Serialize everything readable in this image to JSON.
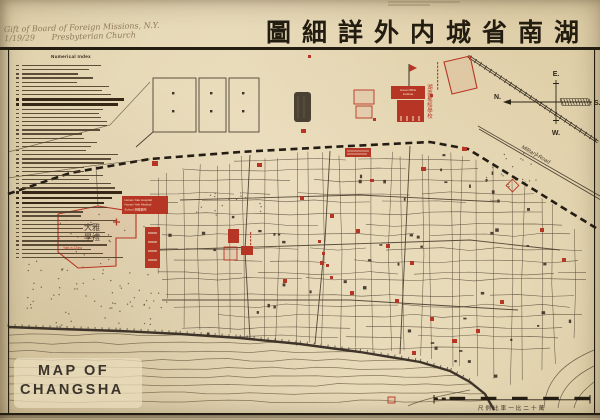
{
  "window": {
    "width": 600,
    "height": 420
  },
  "colors": {
    "paper": "#e9dcb9",
    "ink": "#241d12",
    "map_line": "#564737",
    "dark": "#3a3126",
    "red": "#b73524",
    "water": "#6f5f46"
  },
  "annotations": {
    "handwriting_line1": "Gift of Board of Foreign Missions, N.Y.",
    "handwriting_date": "1/19/29",
    "handwriting_line2": "Presbyterian Church"
  },
  "title": {
    "chinese_rtl": "圖細詳外内城省南湖"
  },
  "legend": {
    "title": "Numerical Index"
  },
  "compass": {
    "north": "N.",
    "south": "S.",
    "east": "E.",
    "west": "W."
  },
  "corner_label": {
    "line1": "MAP OF",
    "line2": "CHANGSHA"
  },
  "roads": {
    "military_road": "Military Road"
  },
  "scale_bar": {
    "caption": "尺例比率一比二十萬"
  },
  "sites": {
    "bible_institute": {
      "label_en_1": "Hunan Bible",
      "label_en_2": "Institute",
      "label_zh": "湖南聖經學校"
    },
    "hunan_yale": {
      "line1": "Hunan-Yale Hospital",
      "line2": "Hunan-Yale Medical",
      "line3": "School 湘雅醫院"
    },
    "yale_in_china": {
      "label_en": "Yale-in-China",
      "label_zh_row1": "大雅",
      "label_zh_row2": "學禮"
    }
  },
  "markers": [
    {
      "x": 308,
      "y": 55,
      "w": 3,
      "h": 3,
      "s": "solid"
    },
    {
      "x": 430,
      "y": 94,
      "w": 3,
      "h": 3,
      "s": "solid"
    },
    {
      "x": 373,
      "y": 118,
      "w": 3,
      "h": 3,
      "s": "solid"
    },
    {
      "x": 354,
      "y": 90,
      "w": 20,
      "h": 14,
      "s": "outline"
    },
    {
      "x": 356,
      "y": 106,
      "w": 16,
      "h": 12,
      "s": "outline"
    },
    {
      "x": 345,
      "y": 148,
      "w": 26,
      "h": 9,
      "s": "label"
    },
    {
      "x": 301,
      "y": 129,
      "w": 5,
      "h": 4,
      "s": "solid"
    },
    {
      "x": 152,
      "y": 161,
      "w": 6,
      "h": 5,
      "s": "solid"
    },
    {
      "x": 257,
      "y": 163,
      "w": 5,
      "h": 4,
      "s": "solid"
    },
    {
      "x": 421,
      "y": 167,
      "w": 5,
      "h": 4,
      "s": "solid"
    },
    {
      "x": 462,
      "y": 147,
      "w": 5,
      "h": 4,
      "s": "solid"
    },
    {
      "x": 370,
      "y": 179,
      "w": 4,
      "h": 3,
      "s": "solid"
    },
    {
      "x": 508,
      "y": 181,
      "w": 9,
      "h": 9,
      "s": "diamond"
    },
    {
      "x": 540,
      "y": 228,
      "w": 4,
      "h": 4,
      "s": "solid"
    },
    {
      "x": 562,
      "y": 258,
      "w": 4,
      "h": 4,
      "s": "solid"
    },
    {
      "x": 300,
      "y": 196,
      "w": 4,
      "h": 4,
      "s": "solid"
    },
    {
      "x": 330,
      "y": 214,
      "w": 4,
      "h": 4,
      "s": "solid"
    },
    {
      "x": 356,
      "y": 229,
      "w": 4,
      "h": 4,
      "s": "solid"
    },
    {
      "x": 386,
      "y": 244,
      "w": 4,
      "h": 4,
      "s": "solid"
    },
    {
      "x": 410,
      "y": 261,
      "w": 4,
      "h": 4,
      "s": "solid"
    },
    {
      "x": 320,
      "y": 261,
      "w": 4,
      "h": 4,
      "s": "solid"
    },
    {
      "x": 283,
      "y": 279,
      "w": 4,
      "h": 4,
      "s": "solid"
    },
    {
      "x": 350,
      "y": 291,
      "w": 4,
      "h": 4,
      "s": "solid"
    },
    {
      "x": 395,
      "y": 299,
      "w": 4,
      "h": 4,
      "s": "solid"
    },
    {
      "x": 430,
      "y": 317,
      "w": 4,
      "h": 4,
      "s": "solid"
    },
    {
      "x": 452,
      "y": 339,
      "w": 5,
      "h": 4,
      "s": "solid"
    },
    {
      "x": 412,
      "y": 351,
      "w": 4,
      "h": 4,
      "s": "solid"
    },
    {
      "x": 500,
      "y": 300,
      "w": 4,
      "h": 4,
      "s": "solid"
    },
    {
      "x": 476,
      "y": 329,
      "w": 4,
      "h": 4,
      "s": "solid"
    },
    {
      "x": 388,
      "y": 397,
      "w": 7,
      "h": 6,
      "s": "outline"
    },
    {
      "x": 228,
      "y": 229,
      "w": 11,
      "h": 14,
      "s": "solid"
    },
    {
      "x": 241,
      "y": 246,
      "w": 12,
      "h": 9,
      "s": "solid"
    },
    {
      "x": 224,
      "y": 247,
      "w": 13,
      "h": 13,
      "s": "outline"
    },
    {
      "x": 318,
      "y": 240,
      "w": 3,
      "h": 3,
      "s": "solid"
    },
    {
      "x": 322,
      "y": 252,
      "w": 3,
      "h": 3,
      "s": "solid"
    },
    {
      "x": 326,
      "y": 264,
      "w": 3,
      "h": 3,
      "s": "solid"
    },
    {
      "x": 330,
      "y": 276,
      "w": 3,
      "h": 3,
      "s": "solid"
    },
    {
      "x": 444,
      "y": 60,
      "w": 0,
      "h": 0,
      "s": "quad"
    }
  ]
}
